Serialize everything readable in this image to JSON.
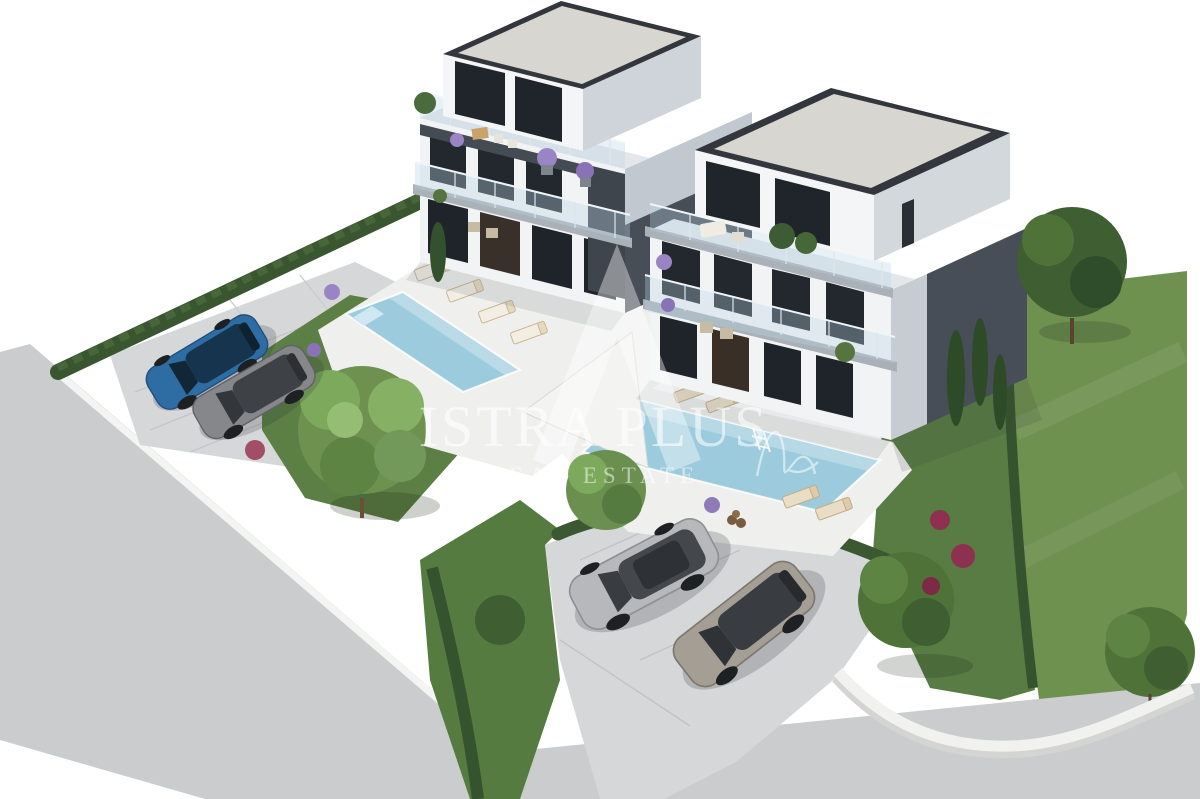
{
  "watermark": {
    "brand": "ISTRA PLUS",
    "tagline": "REAL ESTATE",
    "logo": "peak-monogram-icon",
    "color": "#ffffff"
  },
  "palette": {
    "background": "#ffffff",
    "facade_white": "#f2f3f4",
    "facade_shadow": "#dfe3e6",
    "side_wall_light": "#c3cad1",
    "side_wall_dark": "#474e57",
    "balcony_dark_frame": "#3f454d",
    "roof_surface": "#d8d6d1",
    "roof_parapet": "#33373d",
    "glass_dark": "#22272d",
    "pool_water": "#9ccbdd",
    "deck_white": "#eff0ee",
    "road_gray": "#cbcccd",
    "paver_gray": "#d6d7d9",
    "lawn_green": "#6f9150",
    "garden_green": "#5c7f45",
    "hedge_green": "#3a5631",
    "tree_light_green": "#7da95c",
    "tree_dark_green": "#3f5f33",
    "flower_purple": "#9b84c6",
    "flower_magenta": "#8e3050",
    "car_blue": "#2e6da4",
    "car_gray": "#85878b",
    "car_silver": "#b6b8bb",
    "car_bronze": "#a49e95",
    "wall_white": "#f1f1ef"
  },
  "scene": {
    "buildings": [
      {
        "name": "left-villa",
        "floors": 3,
        "roof": "flat",
        "balconies": "glass",
        "roof_terrace": true,
        "pool": true
      },
      {
        "name": "right-villa",
        "floors": 3,
        "roof": "flat",
        "balconies": "glass",
        "roof_terrace": true,
        "pool": true
      }
    ],
    "pools": [
      {
        "name": "left-pool"
      },
      {
        "name": "right-pool"
      }
    ],
    "vehicles": [
      {
        "name": "blue-suv",
        "area": "left-parking"
      },
      {
        "name": "gray-suv",
        "area": "left-parking"
      },
      {
        "name": "silver-suv",
        "area": "front-parking"
      },
      {
        "name": "bronze-suv",
        "area": "front-parking"
      }
    ],
    "sun_loungers": 8
  }
}
